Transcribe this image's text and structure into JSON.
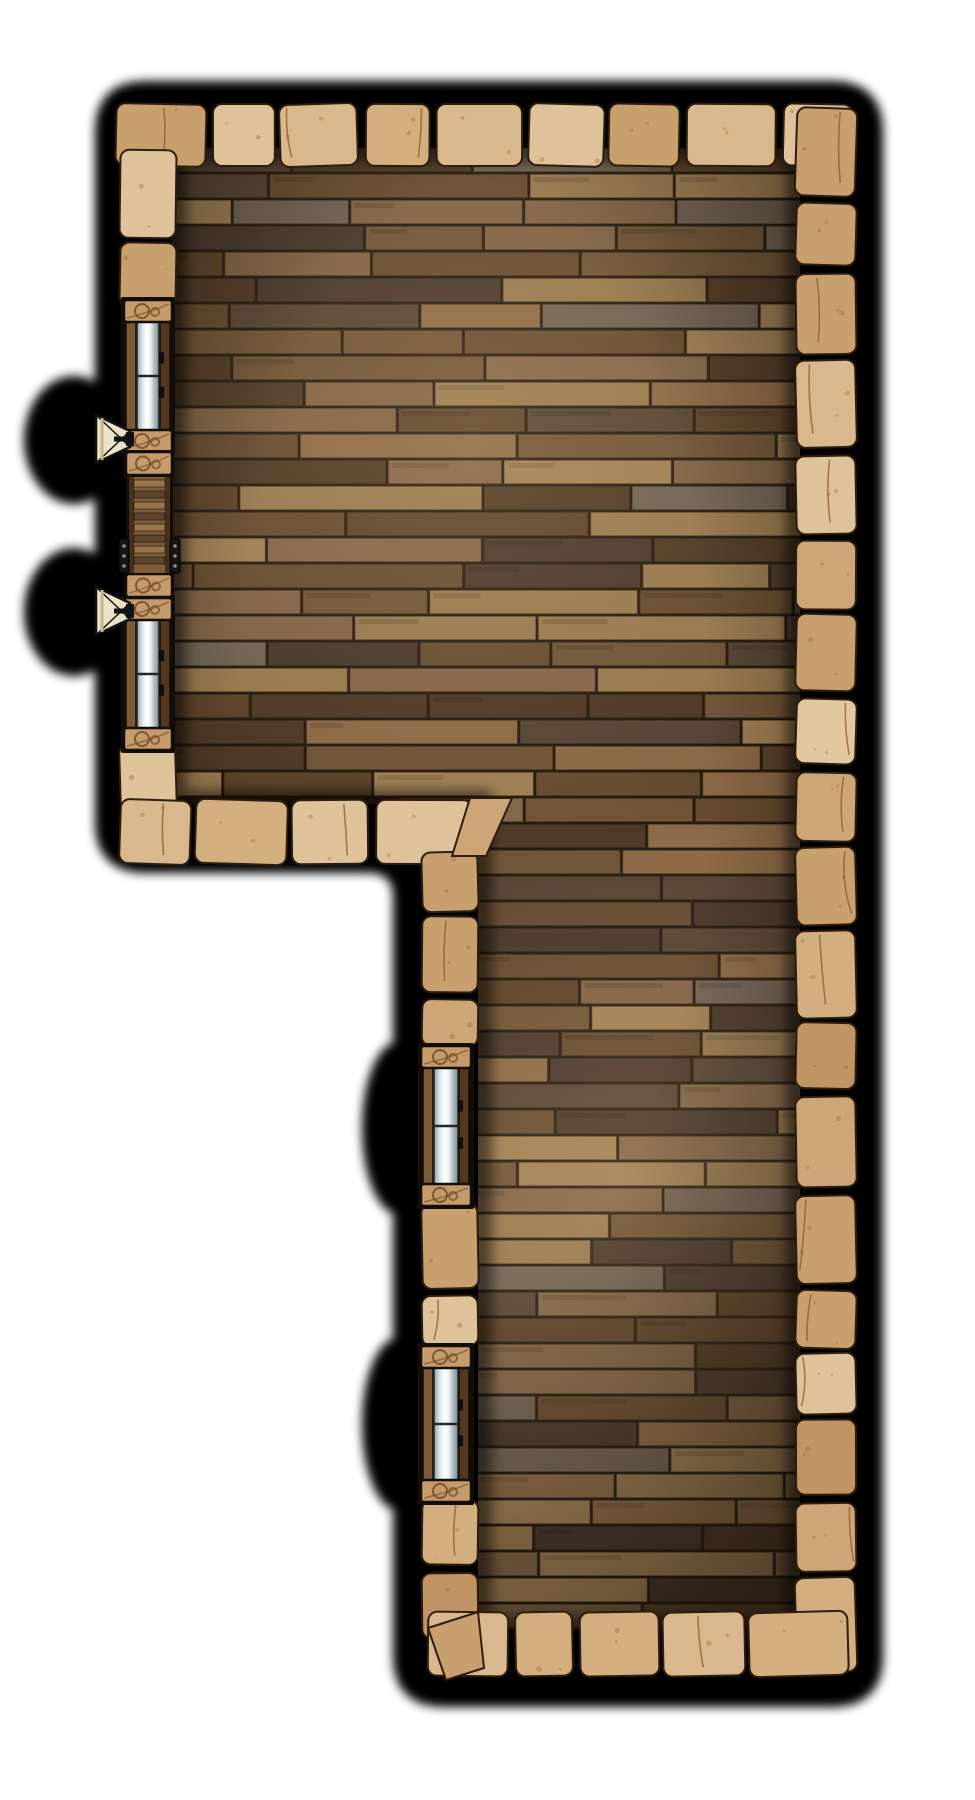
{
  "page": {
    "width": 975,
    "height": 1800,
    "background": "#ffffff"
  },
  "map": {
    "name": "L-shaped wooden-floor room battle map tile",
    "style": "top-down dungeon tile with plank floor, stone block walls, black shadow outline",
    "seed": 1337,
    "palette": {
      "outline_black": "#000000",
      "floor_base": "#271b10",
      "plank_shades": [
        "#8a6845",
        "#6d5236",
        "#5a4129",
        "#7d6144",
        "#4b3724",
        "#95784e",
        "#6e6052",
        "#63492f",
        "#9d7e54",
        "#544233",
        "#816448",
        "#46352a"
      ],
      "plank_seam": "#1a120a",
      "stone_shades": [
        "#dec29a",
        "#d3ae7e",
        "#c7a06e",
        "#e2c89e",
        "#cda677",
        "#c19563",
        "#d8b88c"
      ],
      "stone_outline": "#2e1d0e",
      "stone_crack": "#8a5528",
      "glass_edge": "#20262a",
      "frame_light": "#7d5a36",
      "frame_dark": "#53371f",
      "block_fill": "#c69b6a",
      "block_pattern": "#6f4b27",
      "feature_outline": "#130d07",
      "shutter_body": "#7d5c38",
      "shutter_rail": "#47301c",
      "rung_light": "#97744a",
      "rung_dark": "#5f452b",
      "bracket": "#151515",
      "bracket_dot": "#8d8d8d",
      "sconce_fill": "#ece2c8",
      "sconce_shade": "#c9b88f",
      "sconce_line": "#121212",
      "vignette": "#140c04",
      "glow_warm": "#ffdfa8"
    },
    "outline": {
      "left": 100,
      "top": 86,
      "right": 878,
      "bottom": 1702,
      "notch_x": 398,
      "notch_y": 868,
      "corner_r": 46,
      "notch_r": 30,
      "blur": 5
    },
    "shadow_bulges": [
      {
        "cx": 74,
        "cy": 440,
        "rx": 50,
        "ry": 64
      },
      {
        "cx": 74,
        "cy": 612,
        "rx": 50,
        "ry": 64
      },
      {
        "cx": 398,
        "cy": 1128,
        "rx": 36,
        "ry": 86
      },
      {
        "cx": 398,
        "cy": 1424,
        "rx": 36,
        "ry": 86
      }
    ],
    "floor": {
      "top_room": {
        "x": 172,
        "y": 148,
        "w": 628,
        "h": 656
      },
      "lower_room": {
        "x": 478,
        "y": 804,
        "w": 322,
        "h": 826
      },
      "row_h": 26,
      "seg_min": 110,
      "seg_max": 270
    },
    "lighting": {
      "spots": [
        {
          "cx": 470,
          "cy": 430,
          "r": 430
        },
        {
          "cx": 635,
          "cy": 1190,
          "r": 410
        }
      ],
      "glow_alpha": 0.17,
      "edge_alpha": 0.55
    },
    "walls": [
      {
        "id": "wall-top",
        "dir": "h",
        "from": 116,
        "to": 852,
        "cross": 104,
        "thick": 62
      },
      {
        "id": "wall-right",
        "dir": "v",
        "from": 108,
        "to": 1672,
        "cross": 796,
        "thick": 60
      },
      {
        "id": "wall-left-upper",
        "dir": "v",
        "from": 150,
        "to": 306,
        "cross": 120,
        "thick": 56
      },
      {
        "id": "wall-left-lower",
        "dir": "v",
        "from": 744,
        "to": 812,
        "cross": 120,
        "thick": 56
      },
      {
        "id": "wall-toproom-bottom",
        "dir": "h",
        "from": 120,
        "to": 472,
        "cross": 800,
        "thick": 64
      },
      {
        "id": "wall-lowerleft-a",
        "dir": "v",
        "from": 852,
        "to": 1046,
        "cross": 422,
        "thick": 56
      },
      {
        "id": "wall-lowerleft-b",
        "dir": "v",
        "from": 1204,
        "to": 1346,
        "cross": 422,
        "thick": 56
      },
      {
        "id": "wall-lowerleft-c",
        "dir": "v",
        "from": 1500,
        "to": 1638,
        "cross": 422,
        "thick": 56
      },
      {
        "id": "wall-lower-bottom",
        "dir": "h",
        "from": 428,
        "to": 848,
        "cross": 1612,
        "thick": 64
      }
    ],
    "corner_stones": [
      {
        "id": "corner-inner",
        "points": "470,798 512,798 486,856 452,856"
      },
      {
        "id": "corner-lower-left",
        "points": "428,1628 478,1612 484,1668 446,1680"
      }
    ],
    "windows": [
      {
        "id": "window-1",
        "x": 124,
        "y": 300,
        "w": 48,
        "h": 152
      },
      {
        "id": "window-2",
        "x": 124,
        "y": 598,
        "w": 48,
        "h": 152
      },
      {
        "id": "window-3",
        "x": 421,
        "y": 1046,
        "w": 50,
        "h": 160
      },
      {
        "id": "window-4",
        "x": 421,
        "y": 1346,
        "w": 50,
        "h": 156
      }
    ],
    "filler_blocks": [
      {
        "id": "filler-block-1",
        "x": 126,
        "y": 452,
        "w": 46,
        "h": 23
      },
      {
        "id": "filler-block-2",
        "x": 126,
        "y": 574,
        "w": 46,
        "h": 23
      }
    ],
    "shutter": {
      "id": "shuttered-window",
      "x": 129,
      "y": 477,
      "w": 41,
      "h": 96,
      "bracket_y_off": 62
    },
    "sconces": [
      {
        "id": "sconce-1",
        "wall_x": 126,
        "cy": 439
      },
      {
        "id": "sconce-2",
        "wall_x": 126,
        "cy": 611
      }
    ]
  }
}
